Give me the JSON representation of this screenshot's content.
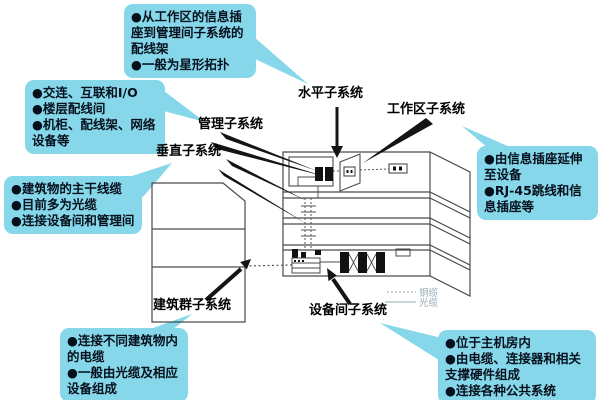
{
  "callouts": {
    "top": {
      "items": [
        "●从工作区的信息插座到管理间子系统的配线架",
        "●一般为星形拓扑"
      ]
    },
    "management_note": {
      "items": [
        "●交连、互联和I/O",
        "●楼层配线间",
        "●机柜、配线架、网络设备等"
      ]
    },
    "vertical_note": {
      "items": [
        "●建筑物的主干线缆",
        "●目前多为光缆",
        "●连接设备间和管理间"
      ]
    },
    "campus_note": {
      "items": [
        "●连接不同建筑物内的电缆",
        "●一般由光缆及相应设备组成"
      ]
    },
    "workarea_note": {
      "items": [
        "●由信息插座延伸至设备",
        "●RJ-45跳线和信息插座等"
      ]
    },
    "equipment_note": {
      "items": [
        "●位于主机房内",
        "●由电缆、连接器和相关支撑硬件组成",
        "●连接各种公共系统"
      ]
    }
  },
  "labels": {
    "horizontal": "水平子系统",
    "workarea": "工作区子系统",
    "management": "管理子系统",
    "vertical": "垂直子系统",
    "campus": "建筑群子系统",
    "equipment_room": "设备间子系统"
  },
  "legend": {
    "copper_label": "铜缆",
    "fiber_label": "光缆"
  },
  "colors": {
    "callout_bg": "#86d7ea",
    "label_text": "#000000",
    "diagram_line": "#4a4a4a",
    "arrow": "#141414",
    "legend_text": "#96abb6"
  }
}
